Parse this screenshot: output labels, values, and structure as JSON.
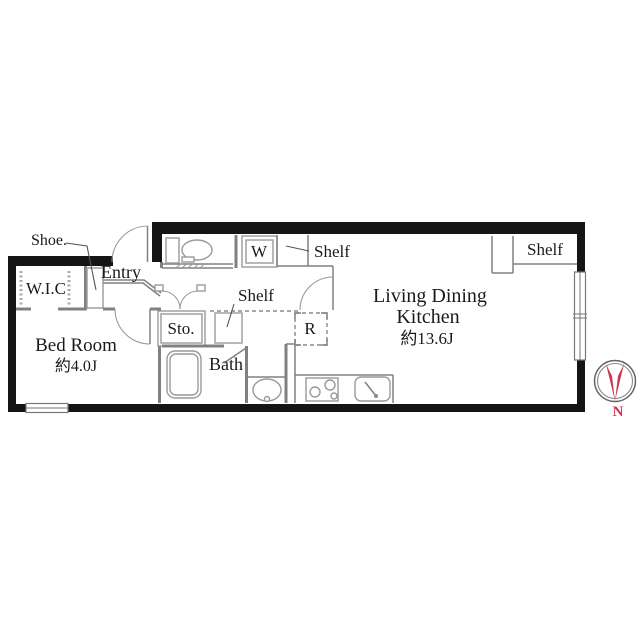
{
  "labels": {
    "shoe": "Shoe.",
    "wic": "W.I.C",
    "entry": "Entry",
    "bedroom_name": "Bed Room",
    "bedroom_size": "約4.0J",
    "storage": "Sto.",
    "bath": "Bath",
    "washer": "W",
    "fridge": "R",
    "shelf_top": "Shelf",
    "shelf_hall": "Shelf",
    "shelf_right": "Shelf",
    "ldk_line1": "Living Dining",
    "ldk_line2": "Kitchen",
    "ldk_size": "約13.6J",
    "compass_north": "N"
  },
  "colors": {
    "wall": "#151515",
    "interior_line": "#808080",
    "compass_red": "#d0344e",
    "background": "#ffffff"
  }
}
